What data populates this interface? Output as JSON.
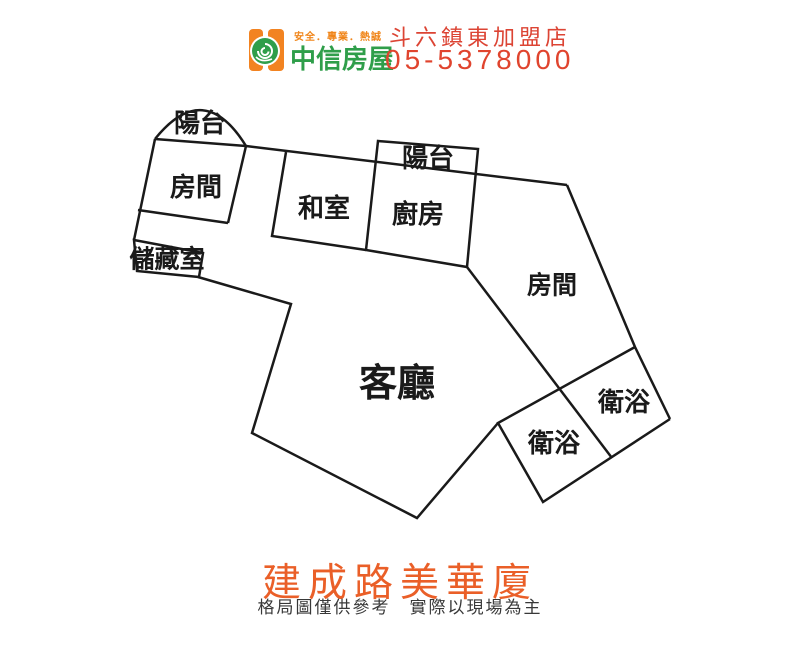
{
  "header": {
    "slogan": "安全．專業．熱誠",
    "brand": "中信房屋",
    "franchise": "斗六鎮東加盟店",
    "phone": "05-5378000"
  },
  "floorplan": {
    "rooms": [
      {
        "id": "balcony-1",
        "label": "陽台"
      },
      {
        "id": "bedroom-1",
        "label": "房間"
      },
      {
        "id": "storage",
        "label": "儲藏室"
      },
      {
        "id": "tatami-room",
        "label": "和室"
      },
      {
        "id": "balcony-2",
        "label": "陽台"
      },
      {
        "id": "kitchen",
        "label": "廚房"
      },
      {
        "id": "bedroom-2",
        "label": "房間"
      },
      {
        "id": "living-room",
        "label": "客廳"
      },
      {
        "id": "bathroom-1",
        "label": "衛浴"
      },
      {
        "id": "bathroom-2",
        "label": "衛浴"
      }
    ]
  },
  "footer": {
    "title": "建成路美華廈",
    "disclaimer": "格局圖僅供參考　實際以現場為主"
  },
  "colors": {
    "brand_green": "#2f9e4a",
    "brand_orange": "#f28321",
    "slogan_orange": "#f08519",
    "accent_red": "#e0442e",
    "title_orange": "#ea5f28",
    "wall_black": "#1a1a1a"
  }
}
